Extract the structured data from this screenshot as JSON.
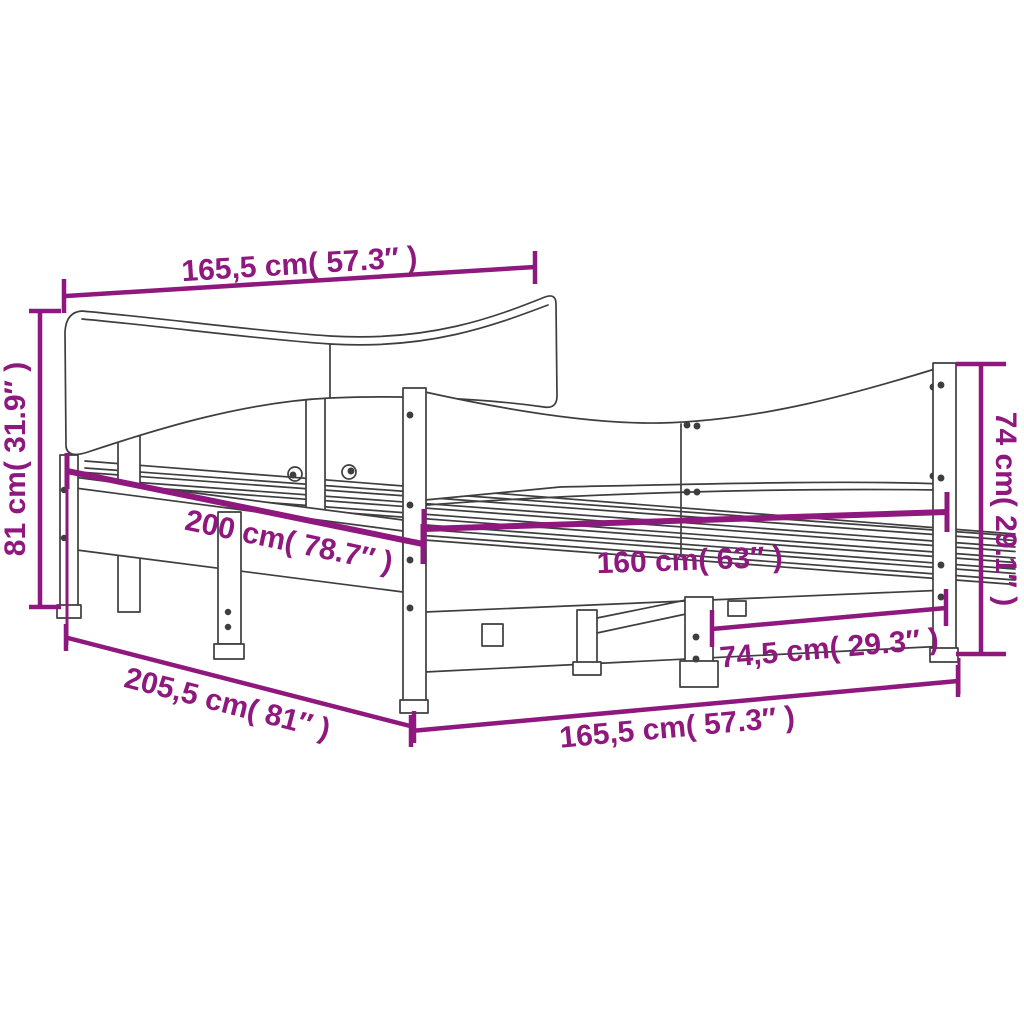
{
  "diagram": {
    "type": "product-dimension-drawing",
    "subject": "bed-frame-with-headboard-and-footboard",
    "colors": {
      "dimension_accent": "#8F187E",
      "outline": "#3E3E3E",
      "background": "#FFFFFF"
    },
    "labels": {
      "headboard_width_top": "165,5 cm( 57.3″ )",
      "headboard_height_left": "81 cm( 31.9″ )",
      "mattress_length": "200 cm( 78.7″ )",
      "mattress_width": "160 cm( 63″ )",
      "footboard_height_right": "74 cm( 29.1″ )",
      "footboard_inner_span": "74,5 cm( 29.3″ )",
      "overall_length": "205,5 cm( 81″ )",
      "footboard_width_bottom": "165,5 cm( 57.3″ )"
    }
  }
}
